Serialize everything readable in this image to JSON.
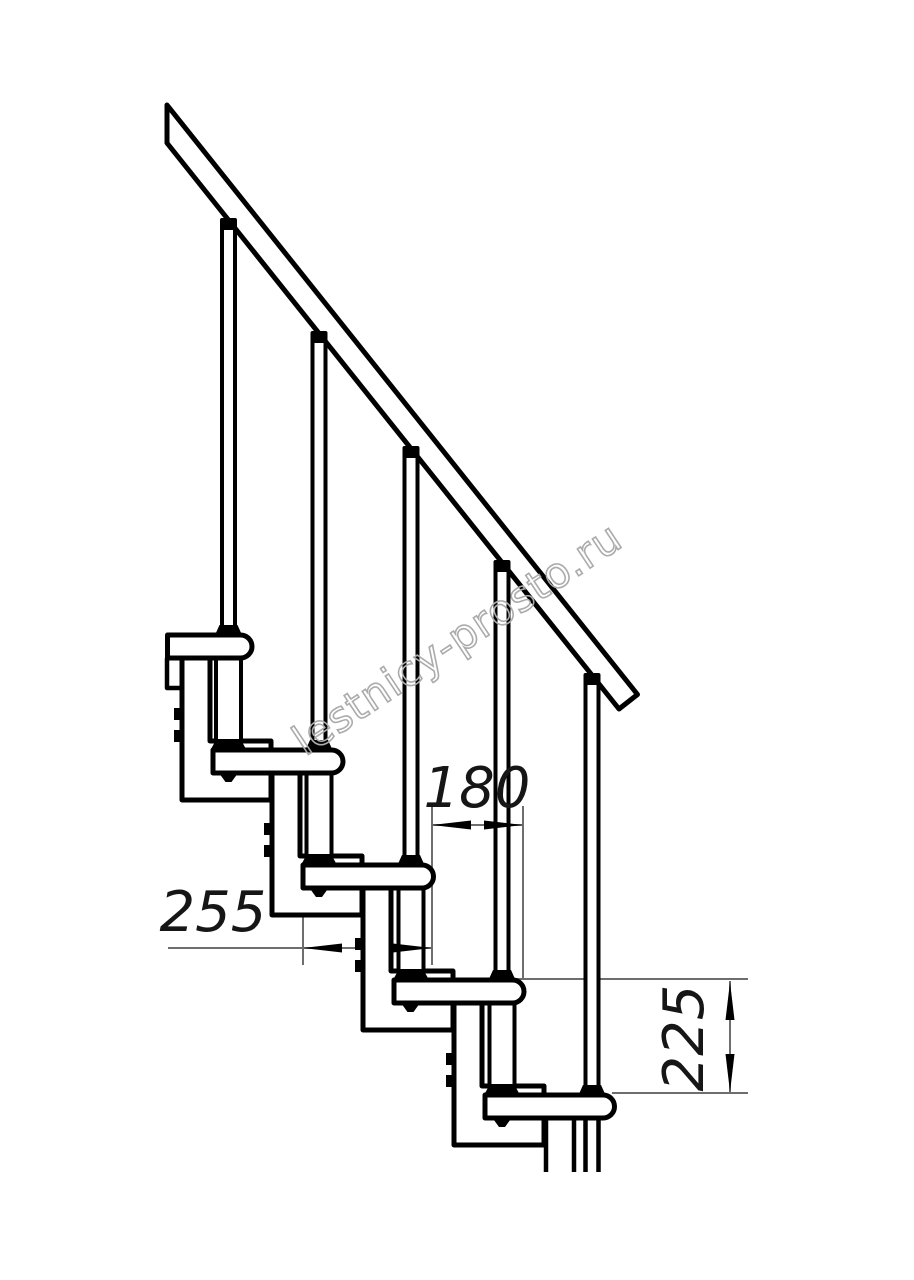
{
  "watermark": {
    "text": "lestnicy-prosto.ru",
    "color": "#ababab"
  },
  "dimensions": {
    "step_spacing": {
      "value": "180"
    },
    "tread_depth": {
      "value": "255"
    },
    "riser_height": {
      "value": "225"
    }
  },
  "colors": {
    "structure_line": "#000000",
    "dimension_line": "#6e6e6e",
    "background": "#ffffff"
  }
}
